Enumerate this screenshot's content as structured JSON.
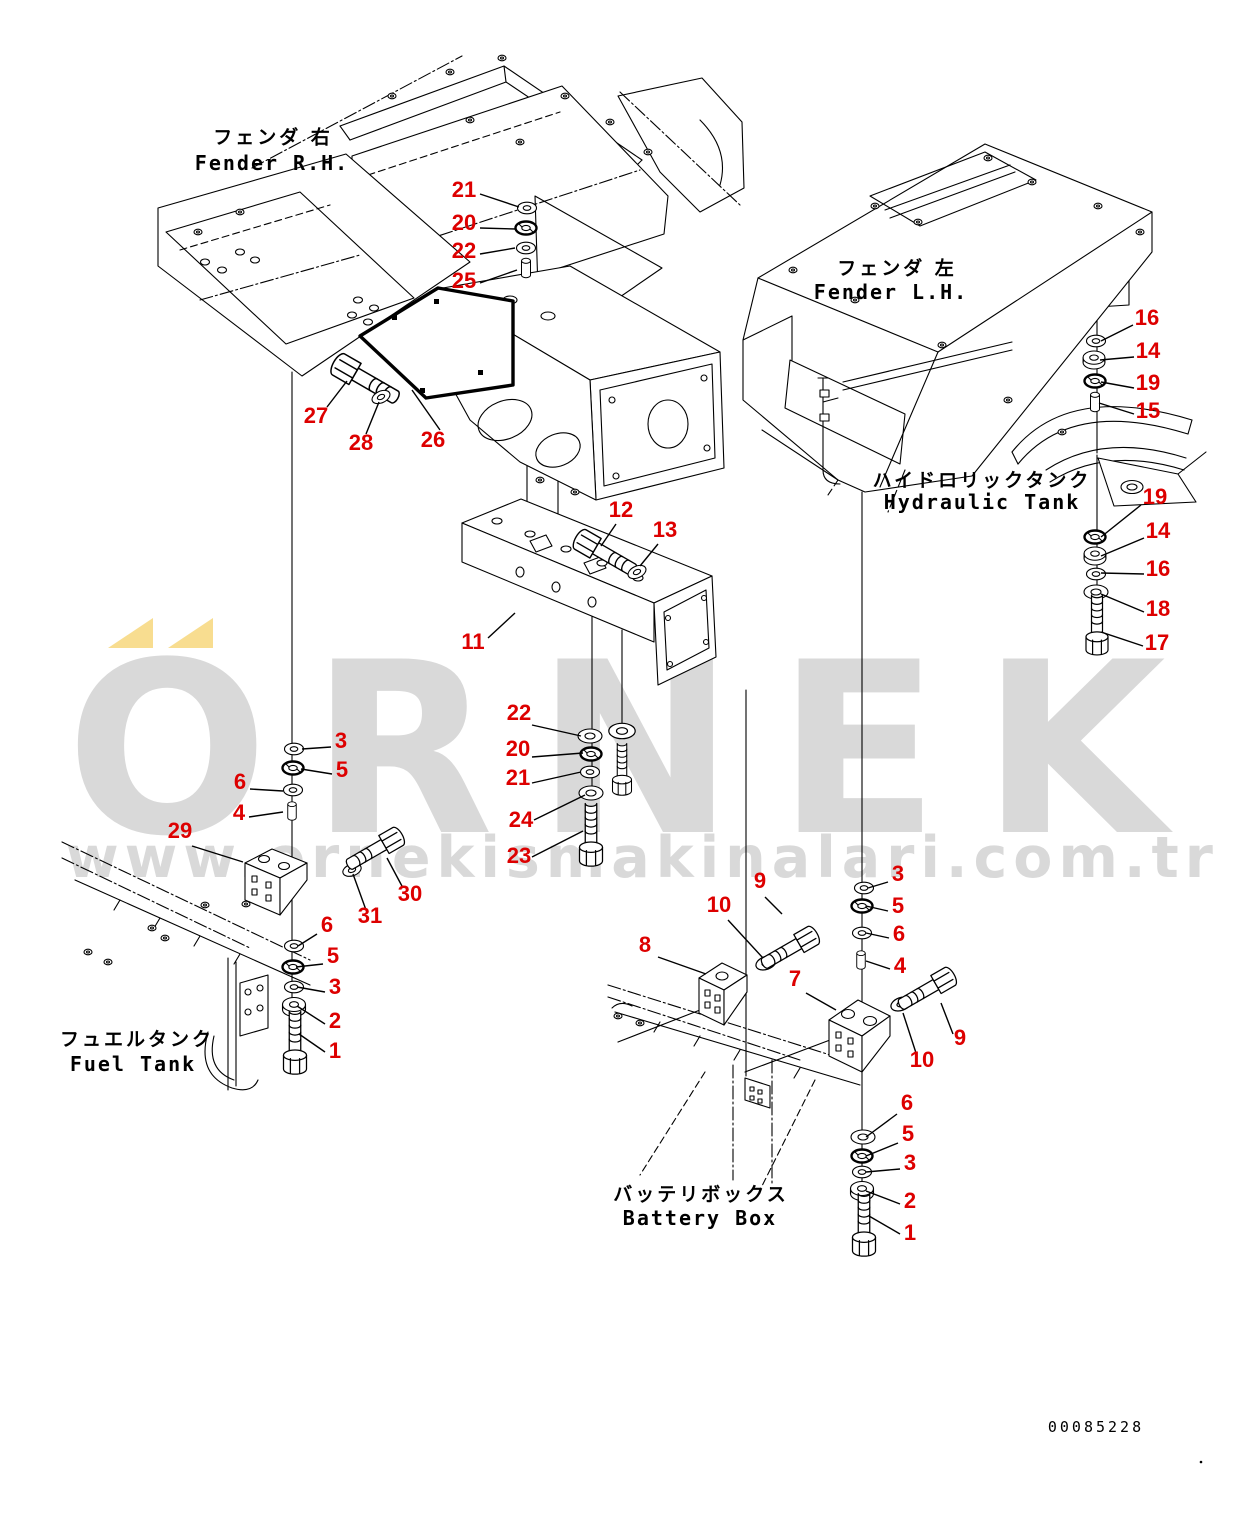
{
  "colors": {
    "callout_red": "#dd0000",
    "line_black": "#000000",
    "watermark_gray": "#d9d9d9",
    "watermark_yellow": "#f8dd90",
    "background": "#ffffff"
  },
  "watermark": {
    "brand_text": "ORNEK",
    "url": "www.ornekismakinalari.com.tr"
  },
  "doc_number": "00085228",
  "area_labels": {
    "fender_rh": {
      "jp": "フェンダ 右",
      "en": "Fender R.H."
    },
    "fender_lh": {
      "jp": "フェンダ 左",
      "en": "Fender L.H."
    },
    "hydraulic_tank": {
      "jp": "ハイドロリックタンク",
      "en": "Hydraulic Tank"
    },
    "fuel_tank": {
      "jp": "フュエルタンク",
      "en": "Fuel Tank"
    },
    "battery_box": {
      "jp": "バッテリボックス",
      "en": "Battery Box"
    }
  },
  "callouts": [
    {
      "n": "21"
    },
    {
      "n": "20"
    },
    {
      "n": "22"
    },
    {
      "n": "25"
    },
    {
      "n": "27"
    },
    {
      "n": "28"
    },
    {
      "n": "26"
    },
    {
      "n": "12"
    },
    {
      "n": "13"
    },
    {
      "n": "11"
    },
    {
      "n": "22"
    },
    {
      "n": "20"
    },
    {
      "n": "21"
    },
    {
      "n": "24"
    },
    {
      "n": "23"
    },
    {
      "n": "3"
    },
    {
      "n": "5"
    },
    {
      "n": "6"
    },
    {
      "n": "4"
    },
    {
      "n": "29"
    },
    {
      "n": "31"
    },
    {
      "n": "30"
    },
    {
      "n": "6"
    },
    {
      "n": "5"
    },
    {
      "n": "3"
    },
    {
      "n": "2"
    },
    {
      "n": "1"
    },
    {
      "n": "9"
    },
    {
      "n": "10"
    },
    {
      "n": "8"
    },
    {
      "n": "7"
    },
    {
      "n": "3"
    },
    {
      "n": "5"
    },
    {
      "n": "6"
    },
    {
      "n": "4"
    },
    {
      "n": "9"
    },
    {
      "n": "10"
    },
    {
      "n": "6"
    },
    {
      "n": "5"
    },
    {
      "n": "3"
    },
    {
      "n": "2"
    },
    {
      "n": "1"
    },
    {
      "n": "16"
    },
    {
      "n": "14"
    },
    {
      "n": "19"
    },
    {
      "n": "15"
    },
    {
      "n": "19"
    },
    {
      "n": "14"
    },
    {
      "n": "16"
    },
    {
      "n": "18"
    },
    {
      "n": "17"
    }
  ]
}
